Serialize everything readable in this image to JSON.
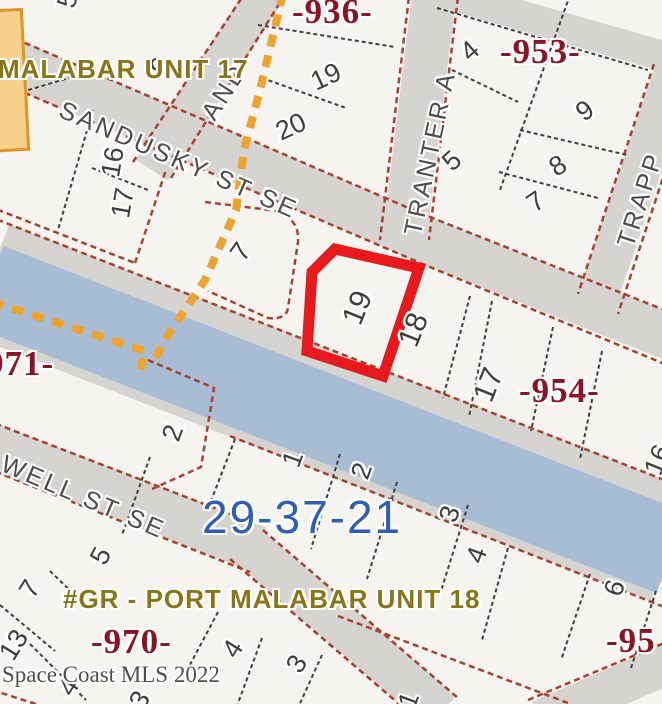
{
  "map": {
    "watermark": "Space Coast MLS 2022",
    "section_number": "29-37-21",
    "unit_labels": {
      "unit17": "MALABAR UNIT 17",
      "unit18": "#GR - PORT MALABAR UNIT 18"
    },
    "plat_numbers": {
      "n936": "-936-",
      "n953": "-953-",
      "n954": "-954-",
      "n970": "-970-",
      "n971": "971-",
      "n955": "-95"
    },
    "streets": {
      "sandusky": "SANDUSKY ST SE",
      "tranter": "TRANTER A",
      "trapp": "TRAPP",
      "unnamed": "AND",
      "well": "WELL ST SE"
    },
    "highlighted_lot": "19",
    "lot_numbers": [
      "5",
      "16",
      "17",
      "7",
      "9",
      "19",
      "20",
      "4",
      "9",
      "5",
      "8",
      "7",
      "19",
      "18",
      "17",
      "16",
      "2",
      "1",
      "2",
      "3",
      "4",
      "6",
      "5",
      "7",
      "13",
      "4",
      "4",
      "3",
      "3",
      "1"
    ]
  },
  "colors": {
    "lot_fill": "#f5f4f1",
    "road_gray": "#d6d4d1",
    "canal_blue": "#a8bcd4",
    "plat_boundary_red": "#a5432c",
    "lot_line_black": "#3f3f3f",
    "subdivision_orange": "#eda32f",
    "highlight_red": "#e8191c",
    "plat_text": "#8c1322",
    "unit_text": "#8b7416",
    "section_text": "#2e5fb5",
    "street_text": "#4c4c4c",
    "lot_text": "#3e3e3e",
    "watermark_text": "#4f4f4f"
  }
}
